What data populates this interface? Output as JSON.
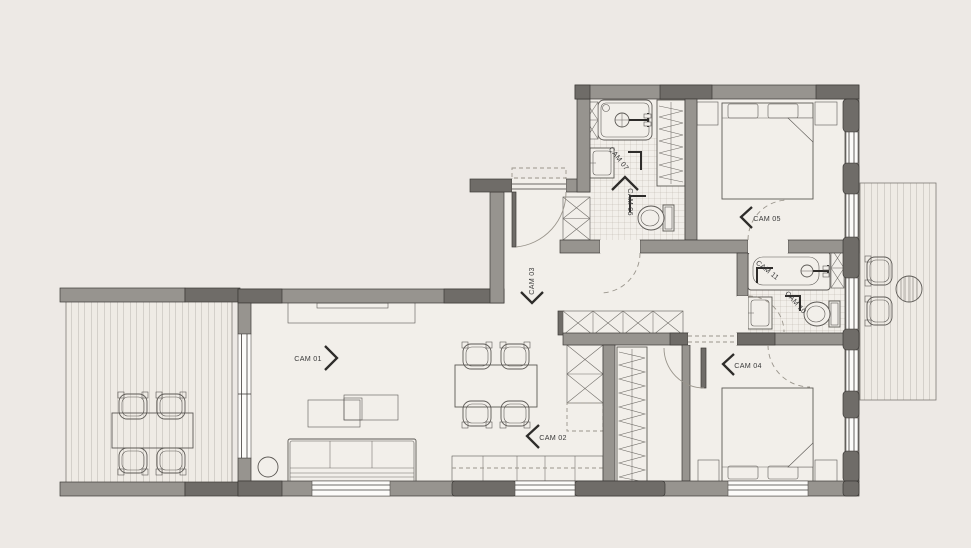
{
  "plan": {
    "title": "apartment-floor-plan",
    "rooms": [
      {
        "id": "cam-01",
        "label": "CAM 01",
        "type": "living-room",
        "direction": "right"
      },
      {
        "id": "cam-02",
        "label": "CAM 02",
        "type": "kitchen-dining",
        "direction": "left"
      },
      {
        "id": "cam-03",
        "label": "CAM 03",
        "type": "entry-hall",
        "direction": "down"
      },
      {
        "id": "cam-04",
        "label": "CAM 04",
        "type": "bedroom",
        "direction": "left"
      },
      {
        "id": "cam-05",
        "label": "CAM 05",
        "type": "bedroom",
        "direction": "left"
      },
      {
        "id": "cam-06",
        "label": "CAM 06",
        "type": "wc",
        "direction": "up"
      },
      {
        "id": "cam-07",
        "label": "CAM 07",
        "type": "bathroom",
        "direction": "up"
      },
      {
        "id": "cam-10",
        "label": "CAM 10",
        "type": "wc",
        "direction": null
      },
      {
        "id": "cam-11",
        "label": "CAM 11",
        "type": "bathroom",
        "direction": null
      }
    ],
    "colors": {
      "background": "#EDE9E5",
      "floor": "#F2EFEA",
      "wall_light": "#97948F",
      "wall_dark": "#6F6C68",
      "outline": "#3C3A37",
      "furniture_line": "#5C5955",
      "tile_line": "#B7B1A7",
      "deck_fill": "#EFEBE5",
      "deck_line": "#A49F96",
      "dashed": "#9A958C",
      "label_text": "#3A3A3A",
      "chevron": "#2E2C2A",
      "window_fill": "#FCFBF9"
    }
  }
}
